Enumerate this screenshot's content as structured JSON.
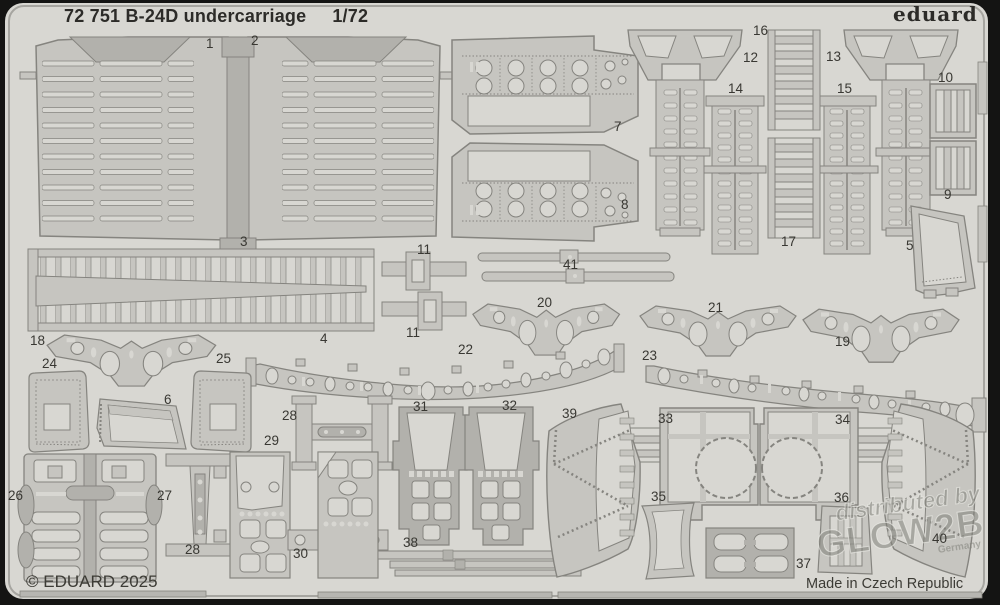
{
  "header": {
    "title": "72 751 B-24D undercarriage",
    "scale": "1/72",
    "brand": "eduard"
  },
  "footer": {
    "copyright": "© EDUARD 2025",
    "origin": "Made in Czech Republic"
  },
  "watermark": {
    "line1": "distributed by",
    "line2": "GLOW2B",
    "line3": "Germany"
  },
  "colors": {
    "background": "#141413",
    "sheet": "#d8d7d2",
    "part": "#c6c5c0",
    "part_dark": "#b2b1ac",
    "outline": "#85847f",
    "label": "#393833"
  },
  "parts": [
    {
      "num": "1",
      "x": 206,
      "y": 36
    },
    {
      "num": "2",
      "x": 251,
      "y": 33
    },
    {
      "num": "3",
      "x": 240,
      "y": 234
    },
    {
      "num": "4",
      "x": 320,
      "y": 331
    },
    {
      "num": "5",
      "x": 906,
      "y": 238
    },
    {
      "num": "6",
      "x": 164,
      "y": 392
    },
    {
      "num": "7",
      "x": 614,
      "y": 119
    },
    {
      "num": "8",
      "x": 621,
      "y": 197
    },
    {
      "num": "9",
      "x": 944,
      "y": 187
    },
    {
      "num": "10",
      "x": 938,
      "y": 70
    },
    {
      "num": "11",
      "x": 417,
      "y": 242
    },
    {
      "num": "11",
      "x": 406,
      "y": 325
    },
    {
      "num": "12",
      "x": 743,
      "y": 50
    },
    {
      "num": "13",
      "x": 826,
      "y": 49
    },
    {
      "num": "14",
      "x": 728,
      "y": 81
    },
    {
      "num": "15",
      "x": 837,
      "y": 81
    },
    {
      "num": "16",
      "x": 753,
      "y": 23
    },
    {
      "num": "17",
      "x": 781,
      "y": 234
    },
    {
      "num": "18",
      "x": 30,
      "y": 333
    },
    {
      "num": "19",
      "x": 835,
      "y": 334
    },
    {
      "num": "20",
      "x": 537,
      "y": 295
    },
    {
      "num": "21",
      "x": 708,
      "y": 300
    },
    {
      "num": "22",
      "x": 458,
      "y": 342
    },
    {
      "num": "23",
      "x": 642,
      "y": 348
    },
    {
      "num": "24",
      "x": 42,
      "y": 356
    },
    {
      "num": "25",
      "x": 216,
      "y": 351
    },
    {
      "num": "26",
      "x": 8,
      "y": 488
    },
    {
      "num": "27",
      "x": 157,
      "y": 488
    },
    {
      "num": "28",
      "x": 282,
      "y": 408
    },
    {
      "num": "28",
      "x": 185,
      "y": 542
    },
    {
      "num": "29",
      "x": 264,
      "y": 433
    },
    {
      "num": "30",
      "x": 293,
      "y": 546
    },
    {
      "num": "31",
      "x": 413,
      "y": 399
    },
    {
      "num": "32",
      "x": 502,
      "y": 398
    },
    {
      "num": "33",
      "x": 658,
      "y": 411
    },
    {
      "num": "34",
      "x": 835,
      "y": 412
    },
    {
      "num": "35",
      "x": 651,
      "y": 489
    },
    {
      "num": "36",
      "x": 834,
      "y": 490
    },
    {
      "num": "37",
      "x": 796,
      "y": 556
    },
    {
      "num": "38",
      "x": 403,
      "y": 535
    },
    {
      "num": "39",
      "x": 562,
      "y": 406
    },
    {
      "num": "40",
      "x": 932,
      "y": 531
    },
    {
      "num": "41",
      "x": 563,
      "y": 257
    }
  ]
}
